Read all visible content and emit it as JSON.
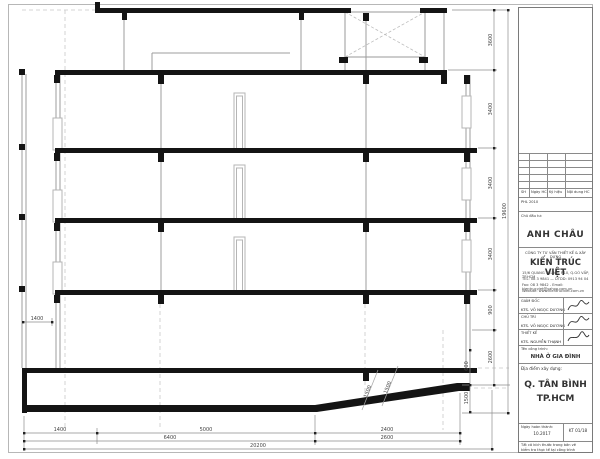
{
  "colors": {
    "ink": "#141414",
    "wall_gray": "#9c9c9c",
    "light_gray": "#c4c4c4",
    "dim_line": "#777777",
    "dim_text": "#444444"
  },
  "title_block": {
    "revision": {
      "headers": [
        "SH",
        "Ngày HC",
        "Ký hiệu",
        "Nội dung HC"
      ],
      "issue_note": "PHL 2010"
    },
    "owner": {
      "label": "Chủ đầu tư:",
      "name": "ANH CHÂU"
    },
    "company": {
      "small": "CÔNG TY TƯ VẤN THIẾT KẾ & XÂY DỰNG",
      "name": "KIẾN TRÚC VIỆT",
      "addr1": "15/6 QUANG TRUNG, P.10, Q.GÒ VẤP, TP.HCM",
      "addr2": "TEL: 08 3 9841 — DTDD: 0913 94 04",
      "addr3": "Fax: 08 3 9842 - Email: kientrucviet@yahoo.com.vn",
      "addr4": "Website: www.kientrucviet.com.vn"
    },
    "signers": [
      {
        "role": "GIÁM ĐỐC",
        "name": "KTS. VÕ NGỌC DƯƠNG"
      },
      {
        "role": "CHỦ TRÌ",
        "name": "KTS. VÕ NGỌC DƯƠNG"
      },
      {
        "role": "THIẾT KẾ",
        "name": "KTS. NGUYỄN THẠNH"
      }
    ],
    "project": {
      "label": "Tên công trình:",
      "name": "NHÀ Ở GIA ĐÌNH"
    },
    "location": {
      "label": "Địa điểm xây dựng:",
      "line1": "Q. TÂN BÌNH",
      "line2": "TP.HCM"
    },
    "completion": {
      "label": "Ngày hoàn thành:",
      "value": "10.2017"
    },
    "sheet_no": "KT 01/18",
    "note1": "Tất cả kích thước trong bản vẽ",
    "note2": "kiểm tra thực tế tại công trình"
  },
  "dims": {
    "bottom1": [
      "1400",
      "5000",
      "2400"
    ],
    "bottom2": [
      "6400",
      "2600"
    ],
    "bottom3": [
      "20200"
    ],
    "right_floors": [
      "3600",
      "3400",
      "3400",
      "3400",
      "900",
      "2600"
    ],
    "right_small": [
      "600",
      "1500"
    ],
    "right_overall": "19600",
    "left_offset": "1400",
    "ramp": [
      "1500",
      "1500"
    ]
  }
}
